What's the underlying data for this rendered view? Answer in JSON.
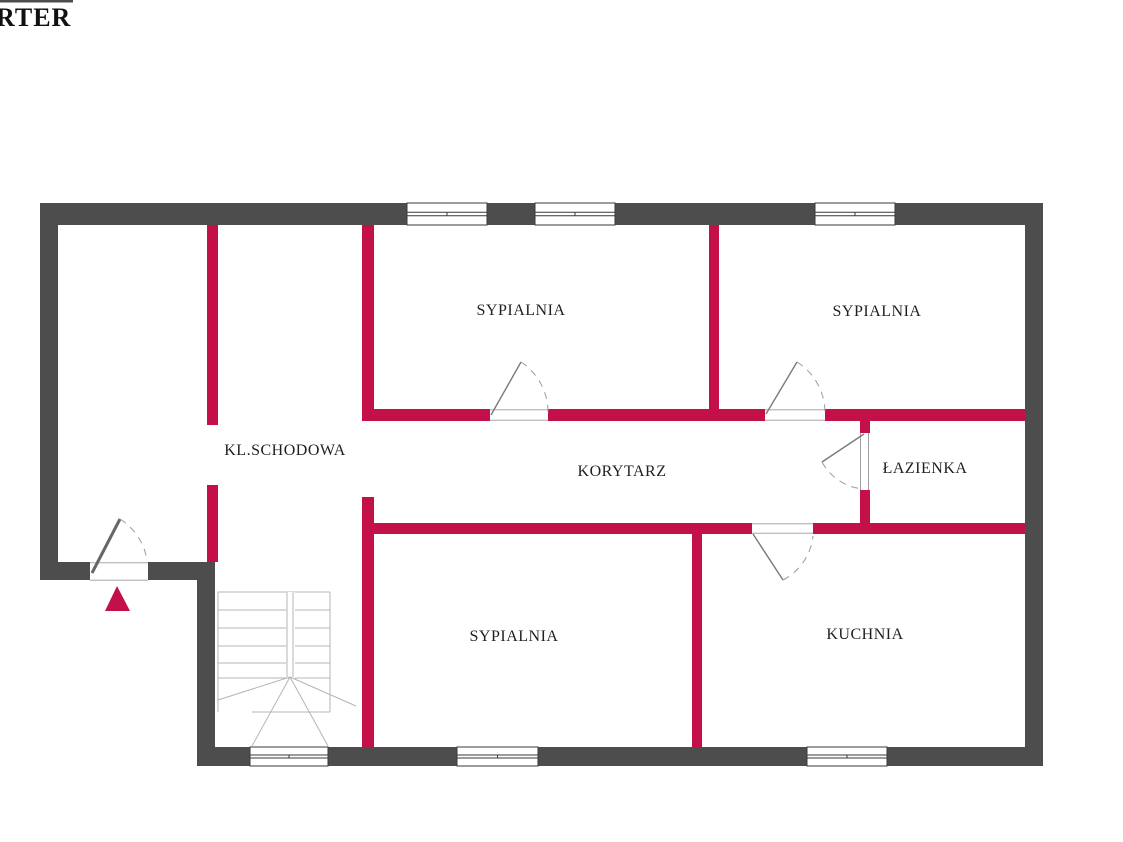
{
  "title": {
    "text": "RTER"
  },
  "palette": {
    "background": "#ffffff",
    "wall_dark": "#4d4d4d",
    "wall_partition_red": "#c41049",
    "window_line": "#3a3a3a",
    "door_line": "#9a9a9a",
    "stair_line": "#b5b5b5",
    "label_text": "#1f1f1f",
    "entrance_arrow_red": "#c41049"
  },
  "rooms": [
    {
      "name": "kl-schodowa",
      "label": "KL.SCHODOWA",
      "cx": 285,
      "cy": 451
    },
    {
      "name": "sypialnia-top-middle",
      "label": "SYPIALNIA",
      "cx": 521,
      "cy": 311
    },
    {
      "name": "sypialnia-top-right",
      "label": "SYPIALNIA",
      "cx": 877,
      "cy": 312
    },
    {
      "name": "korytarz",
      "label": "KORYTARZ",
      "cx": 622,
      "cy": 472
    },
    {
      "name": "lazienka",
      "label": "ŁAZIENKA",
      "cx": 925,
      "cy": 469
    },
    {
      "name": "sypialnia-bottom",
      "label": "SYPIALNIA",
      "cx": 514,
      "cy": 637
    },
    {
      "name": "kuchnia",
      "label": "KUCHNIA",
      "cx": 865,
      "cy": 635
    }
  ],
  "geometry": {
    "canvas": {
      "w": 1123,
      "h": 842
    },
    "clipped_fragment": {
      "x": 0,
      "y": 0,
      "w": 73,
      "h": 2.5
    },
    "outer_walls": [
      {
        "name": "outer-wall-top",
        "x": 40,
        "y": 203,
        "w": 1003,
        "h": 22
      },
      {
        "name": "outer-wall-right",
        "x": 1025,
        "y": 203,
        "w": 18,
        "h": 563
      },
      {
        "name": "outer-wall-bottom",
        "x": 197,
        "y": 747,
        "w": 846,
        "h": 19
      },
      {
        "name": "outer-wall-left",
        "x": 40,
        "y": 203,
        "w": 18,
        "h": 377
      },
      {
        "name": "outer-wall-entry",
        "x": 40,
        "y": 562,
        "w": 175,
        "h": 18
      },
      {
        "name": "outer-wall-lower-left",
        "x": 197,
        "y": 580,
        "w": 18,
        "h": 167
      }
    ],
    "partition_walls": [
      {
        "name": "stair-wall-left-upper",
        "x": 207,
        "y": 225,
        "w": 11,
        "h": 200
      },
      {
        "name": "stair-wall-left-lower",
        "x": 207,
        "y": 485,
        "w": 11,
        "h": 77
      },
      {
        "name": "stair-wall-right-upper",
        "x": 362,
        "y": 225,
        "w": 12,
        "h": 196
      },
      {
        "name": "stair-wall-right-lower",
        "x": 362,
        "y": 497,
        "w": 12,
        "h": 250
      },
      {
        "name": "bedroom-divider-top",
        "x": 709,
        "y": 225,
        "w": 10,
        "h": 196
      },
      {
        "name": "bedroom-kitchen-divider",
        "x": 692,
        "y": 534,
        "w": 10,
        "h": 213
      },
      {
        "name": "corridor-top-wall-1",
        "x": 362,
        "y": 409,
        "w": 128,
        "h": 12
      },
      {
        "name": "corridor-top-wall-2",
        "x": 548,
        "y": 409,
        "w": 217,
        "h": 12
      },
      {
        "name": "corridor-top-wall-3",
        "x": 825,
        "y": 409,
        "w": 200,
        "h": 12
      },
      {
        "name": "corridor-bottom-wall-1",
        "x": 362,
        "y": 523,
        "w": 390,
        "h": 11
      },
      {
        "name": "corridor-bottom-wall-2",
        "x": 813,
        "y": 523,
        "w": 212,
        "h": 11
      },
      {
        "name": "bathroom-wall-upper",
        "x": 860,
        "y": 421,
        "w": 10,
        "h": 12
      },
      {
        "name": "bathroom-wall-lower",
        "x": 860,
        "y": 490,
        "w": 10,
        "h": 33
      }
    ],
    "windows": [
      {
        "name": "window-top-1",
        "x": 407,
        "y": 203,
        "w": 80,
        "h": 22
      },
      {
        "name": "window-top-2",
        "x": 535,
        "y": 203,
        "w": 80,
        "h": 22
      },
      {
        "name": "window-top-3",
        "x": 815,
        "y": 203,
        "w": 80,
        "h": 22
      },
      {
        "name": "window-bottom-1",
        "x": 250,
        "y": 747,
        "w": 78,
        "h": 19
      },
      {
        "name": "window-bottom-2",
        "x": 457,
        "y": 747,
        "w": 81,
        "h": 19
      },
      {
        "name": "window-bottom-3",
        "x": 807,
        "y": 747,
        "w": 80,
        "h": 19
      }
    ],
    "door_gaps": [
      {
        "name": "door-gap-bedroom-mid",
        "x": 490,
        "y": 409,
        "w": 58,
        "h": 12,
        "orient": "h"
      },
      {
        "name": "door-gap-bedroom-right",
        "x": 765,
        "y": 409,
        "w": 60,
        "h": 12,
        "orient": "h"
      },
      {
        "name": "door-gap-bathroom",
        "x": 858,
        "y": 433,
        "w": 14,
        "h": 57,
        "orient": "v"
      },
      {
        "name": "door-gap-kitchen",
        "x": 752,
        "y": 523,
        "w": 61,
        "h": 11,
        "orient": "h"
      },
      {
        "name": "door-gap-entrance",
        "x": 90,
        "y": 562,
        "w": 58,
        "h": 19,
        "orient": "h"
      }
    ],
    "doors": [
      {
        "name": "door-bedroom-mid",
        "leaf": [
          491,
          415,
          521,
          362
        ],
        "arc": "M521,362 A60,60 0 0 1 548,413",
        "entry": false
      },
      {
        "name": "door-bedroom-right",
        "leaf": [
          766,
          414,
          797,
          362
        ],
        "arc": "M797,362 A60,60 0 0 1 825,413",
        "entry": false
      },
      {
        "name": "door-bathroom",
        "leaf": [
          864,
          434,
          822,
          462
        ],
        "arc": "M822,462 A52,52 0 0 0 864,489",
        "entry": false
      },
      {
        "name": "door-kitchen",
        "leaf": [
          753,
          534,
          783,
          580
        ],
        "arc": "M783,580 A56,56 0 0 0 813,536",
        "entry": false
      },
      {
        "name": "door-entrance",
        "leaf": [
          92,
          573,
          120,
          519
        ],
        "arc": "M120,519 A60,60 0 0 1 147,560",
        "entry": true
      }
    ],
    "stairs": {
      "outline": [
        [
          218,
          592,
          330,
          592
        ],
        [
          218,
          592,
          218,
          712
        ],
        [
          330,
          592,
          330,
          712
        ],
        [
          252,
          712,
          330,
          712
        ]
      ],
      "treads": [
        [
          218,
          610,
          330,
          610
        ],
        [
          218,
          628,
          330,
          628
        ],
        [
          218,
          646,
          330,
          646
        ],
        [
          218,
          663,
          330,
          663
        ],
        [
          218,
          678,
          330,
          678
        ]
      ],
      "divider_mask": {
        "x": 286,
        "y": 592,
        "w": 9,
        "h": 86
      },
      "divider": [
        [
          287,
          592,
          287,
          677
        ],
        [
          293,
          592,
          293,
          677
        ]
      ],
      "fan": [
        [
          290,
          677,
          218,
          700
        ],
        [
          290,
          677,
          252,
          746
        ],
        [
          290,
          677,
          328,
          746
        ],
        [
          290,
          677,
          356,
          706
        ]
      ]
    },
    "entrance_arrow": {
      "points": "117,586 130,611 105,611"
    }
  }
}
